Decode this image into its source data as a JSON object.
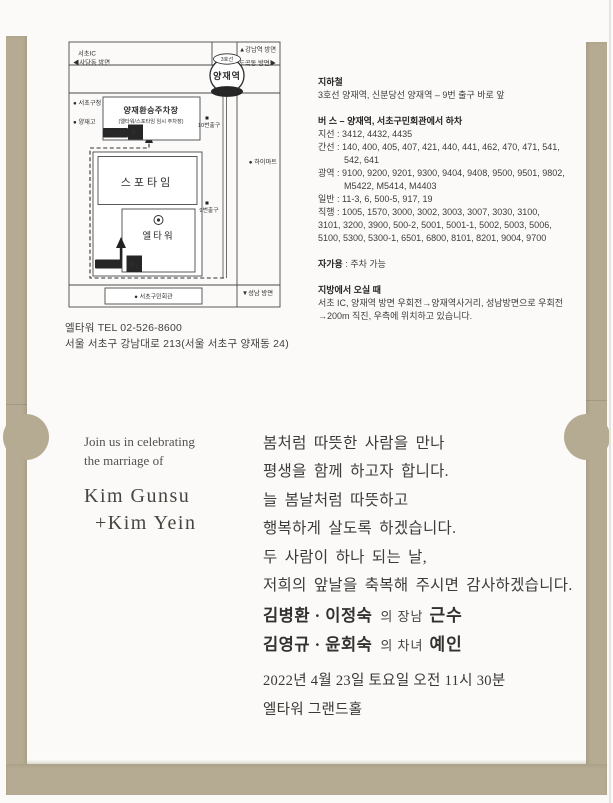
{
  "envelope": {
    "color": "#b5aa92"
  },
  "map": {
    "directions": {
      "seocho_ic": "서초IC",
      "sadang": "◀사당동 방면",
      "gangnam": "▲강남역 방면",
      "dogok": "도곡동 방면▶",
      "seongnam": "▼성남 방면"
    },
    "station": {
      "line3": "3호선",
      "name": "양재역",
      "sinbundang": "신분당선"
    },
    "labels": {
      "seocho_gu_office": "● 서초구청",
      "yangjae_high": "● 양재고",
      "himart": "● 하이마트",
      "community_center": "● 서초구민회관",
      "exit10": "10번출구",
      "exit9": "9번출구",
      "sportime": "스포타임",
      "eltower": "엘타워",
      "parking_name": "양재환승주차장",
      "parking_sub": "(엘타워/스포타임 임시 주차장)",
      "parking_entrance": "주차장 입구",
      "p1": "P₁",
      "p2": "P₂"
    },
    "tel": "엘타워  TEL 02-526-8600",
    "address": "서울 서초구 강남대로 213(서울 서초구 양재동 24)"
  },
  "transit": {
    "subway": {
      "title": "지하철",
      "desc": "3호선 양재역, 신분당선 양재역 – 9번 출구 바로 앞"
    },
    "bus": {
      "title": "버  스 – 양재역, 서초구민회관에서 하차",
      "lines": [
        "지선 : 3412, 4432, 4435",
        "간선 : 140, 400, 405, 407, 421, 440, 441, 462, 470, 471, 541,",
        "542, 641",
        "광역 : 9100, 9200, 9201, 9300, 9404, 9408, 9500, 9501, 9802,",
        "M5422, M5414, M4403",
        "일반 : 11-3, 6, 500-5, 917, 19",
        "직행 : 1005, 1570, 3000, 3002, 3003, 3007, 3030, 3100,",
        "3101, 3200, 3900, 500-2, 5001, 5001-1, 5002, 5003, 5006,",
        "5100, 5300, 5300-1, 6501, 6800, 8101, 8201, 9004, 9700"
      ]
    },
    "car": {
      "label": "자가용",
      "value": " : 주차 가능"
    },
    "from_region": {
      "title": "지방에서 오실 때",
      "lines": [
        "서초 IC, 양재역 방면 우회전→양재역사거리, 성남방면으로 우회전",
        "→200m 직진, 우측에 위치하고 있습니다."
      ]
    }
  },
  "invitation": {
    "english": {
      "line1": "Join us in celebrating",
      "line2": "the marriage of",
      "name1": "Kim Gunsu",
      "name2": "+Kim Yein"
    },
    "message": [
      "봄처럼 따뜻한 사람을 만나",
      "평생을 함께 하고자 합니다.",
      "늘 봄날처럼 따뜻하고",
      "행복하게 살도록 하겠습니다.",
      "두 사람이 하나 되는 날,",
      "저희의 앞날을 축복해 주시면 감사하겠습니다."
    ],
    "groom": {
      "parents": "김병환 · 이정숙",
      "relation": "의 장남",
      "name": "근수"
    },
    "bride": {
      "parents": "김영규 · 윤회숙",
      "relation": "의 차녀",
      "name": "예인"
    },
    "datetime": "2022년 4월 23일 토요일 오전 11시 30분",
    "venue": "엘타워 그랜드홀"
  }
}
